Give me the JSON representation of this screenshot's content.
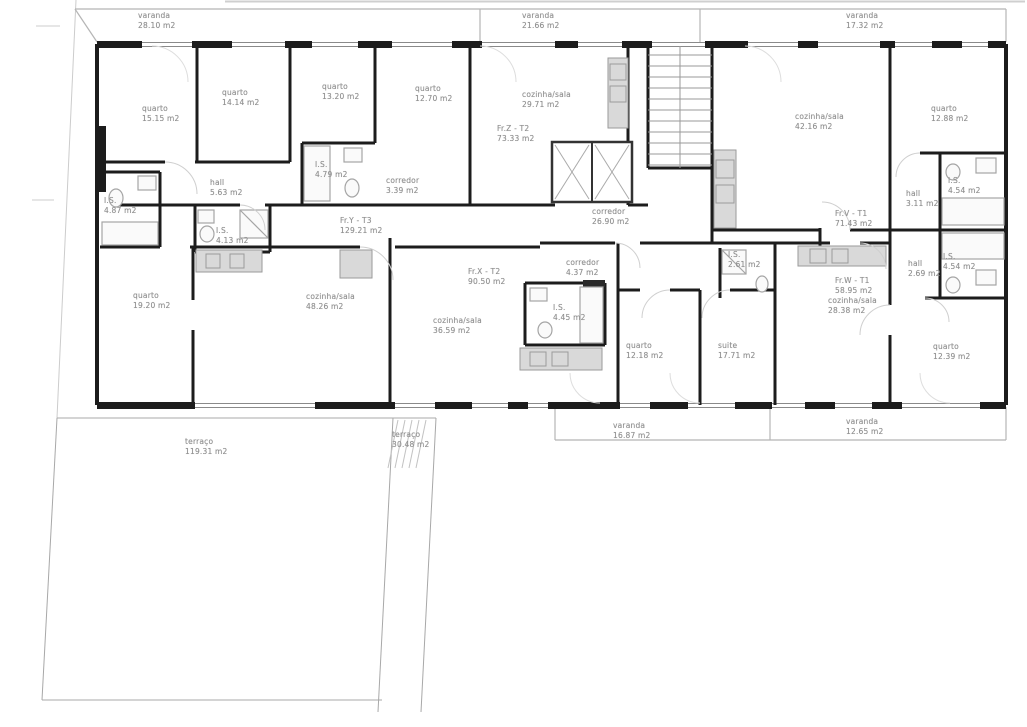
{
  "document": {
    "kind_label": "floor plan drawing",
    "language": "pt"
  },
  "colors": {
    "paper": "#ffffff",
    "wall": "#1c1c1c",
    "fixture": "#a5a5a5",
    "rail": "#b5b5b5",
    "text": "#8f8f8f"
  },
  "labels": [
    {
      "name": "varanda",
      "area": "28.10 m2",
      "x": 138,
      "y": 11
    },
    {
      "name": "varanda",
      "area": "21.66 m2",
      "x": 522,
      "y": 11
    },
    {
      "name": "varanda",
      "area": "17.32 m2",
      "x": 846,
      "y": 11
    },
    {
      "name": "quarto",
      "area": "15.15 m2",
      "x": 142,
      "y": 104
    },
    {
      "name": "quarto",
      "area": "14.14 m2",
      "x": 222,
      "y": 88
    },
    {
      "name": "quarto",
      "area": "13.20 m2",
      "x": 322,
      "y": 82
    },
    {
      "name": "quarto",
      "area": "12.70 m2",
      "x": 415,
      "y": 84
    },
    {
      "name": "cozinha/sala",
      "area": "29.71 m2",
      "x": 522,
      "y": 90
    },
    {
      "name": "Fr.Z - T2",
      "area": "73.33 m2",
      "x": 497,
      "y": 124
    },
    {
      "name": "cozinha/sala",
      "area": "42.16 m2",
      "x": 795,
      "y": 112
    },
    {
      "name": "quarto",
      "area": "12.88 m2",
      "x": 931,
      "y": 104
    },
    {
      "name": "I.S.",
      "area": "4.79 m2",
      "x": 315,
      "y": 160
    },
    {
      "name": "corredor",
      "area": "3.39 m2",
      "x": 386,
      "y": 176
    },
    {
      "name": "hall",
      "area": "5.63 m2",
      "x": 210,
      "y": 178
    },
    {
      "name": "I.S.",
      "area": "4.87 m2",
      "x": 104,
      "y": 196
    },
    {
      "name": "I.S.",
      "area": "4.13 m2",
      "x": 216,
      "y": 226
    },
    {
      "name": "Fr.Y - T3",
      "area": "129.21 m2",
      "x": 340,
      "y": 216
    },
    {
      "name": "corredor",
      "area": "26.90 m2",
      "x": 592,
      "y": 207
    },
    {
      "name": "Fr.V - T1",
      "area": "71.43 m2",
      "x": 835,
      "y": 209
    },
    {
      "name": "hall",
      "area": "3.11 m2",
      "x": 906,
      "y": 189
    },
    {
      "name": "I.S.",
      "area": "4.54 m2",
      "x": 948,
      "y": 176
    },
    {
      "name": "corredor",
      "area": "4.37 m2",
      "x": 566,
      "y": 258
    },
    {
      "name": "I.S.",
      "area": "2.61 m2",
      "x": 728,
      "y": 250
    },
    {
      "name": "hall",
      "area": "2.69 m2",
      "x": 908,
      "y": 259
    },
    {
      "name": "I.S.",
      "area": "4.54 m2",
      "x": 943,
      "y": 252
    },
    {
      "name": "Fr.X - T2",
      "area": "90.50 m2",
      "x": 468,
      "y": 267
    },
    {
      "name": "quarto",
      "area": "19.20 m2",
      "x": 133,
      "y": 291
    },
    {
      "name": "cozinha/sala",
      "area": "48.26 m2",
      "x": 306,
      "y": 292
    },
    {
      "name": "I.S.",
      "area": "4.45 m2",
      "x": 553,
      "y": 303
    },
    {
      "name": "cozinha/sala",
      "area": "36.59 m2",
      "x": 433,
      "y": 316
    },
    {
      "name": "Fr.W - T1",
      "area": "58.95 m2",
      "x": 835,
      "y": 276
    },
    {
      "name": "cozinha/sala",
      "area": "28.38 m2",
      "x": 828,
      "y": 296
    },
    {
      "name": "quarto",
      "area": "12.18 m2",
      "x": 626,
      "y": 341
    },
    {
      "name": "suite",
      "area": "17.71 m2",
      "x": 718,
      "y": 341
    },
    {
      "name": "quarto",
      "area": "12.39 m2",
      "x": 933,
      "y": 342
    },
    {
      "name": "varanda",
      "area": "16.87 m2",
      "x": 613,
      "y": 421
    },
    {
      "name": "varanda",
      "area": "12.65 m2",
      "x": 846,
      "y": 417
    },
    {
      "name": "terraço",
      "area": "119.31 m2",
      "x": 185,
      "y": 437
    },
    {
      "name": "terraço",
      "area": "30.48 m2",
      "x": 392,
      "y": 430
    }
  ]
}
